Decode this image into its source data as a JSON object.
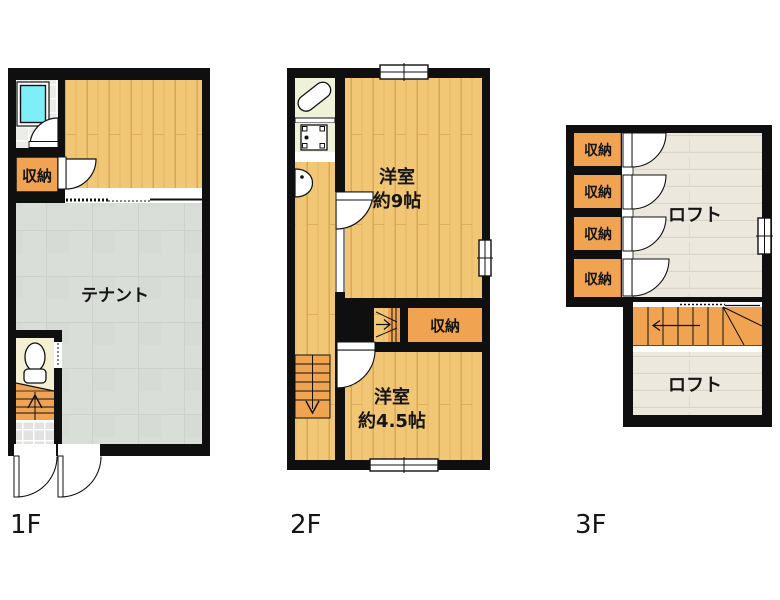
{
  "title": "3-story floor plan",
  "floors": [
    {
      "label": "1F",
      "rooms": [
        {
          "name": "storage",
          "label": "収納"
        },
        {
          "name": "tenant",
          "label": "テナント"
        }
      ],
      "fixtures": [
        "bathtub",
        "toilet",
        "stairs-up",
        "entry-doors"
      ]
    },
    {
      "label": "2F",
      "rooms": [
        {
          "name": "western-room-9",
          "label": "洋室",
          "size": "約9帖"
        },
        {
          "name": "storage",
          "label": "収納"
        },
        {
          "name": "western-room-4-5",
          "label": "洋室",
          "size": "約4.5帖"
        }
      ],
      "fixtures": [
        "bathtub",
        "washing-machine",
        "sink",
        "stairs-down",
        "stairs-up",
        "windows"
      ]
    },
    {
      "label": "3F",
      "rooms": [
        {
          "name": "storage-1",
          "label": "収納"
        },
        {
          "name": "storage-2",
          "label": "収納"
        },
        {
          "name": "storage-3",
          "label": "収納"
        },
        {
          "name": "storage-4",
          "label": "収納"
        },
        {
          "name": "loft-upper",
          "label": "ロフト"
        },
        {
          "name": "loft-lower",
          "label": "ロフト"
        }
      ],
      "fixtures": [
        "stairs-winder",
        "window"
      ]
    }
  ],
  "colors": {
    "wall": "#0f0f0f",
    "wood_floor": "#f1c674",
    "wood_plank_line": "#d9a854",
    "storage_orange": "#f0a351",
    "tenant_gray": "#dadenine",
    "tenant_floor": "#daded9",
    "loft_floor": "#ece8de",
    "cream_1f": "#f4f0d4",
    "cream_2f": "#eff2d8",
    "entry_tile": "#e2e2e0",
    "bath_tile": "#ececе8",
    "bath_tile_f": "#ecece8",
    "bathtub_cyan": "#7eeff6"
  },
  "icons": {
    "bathtub-icon": "rounded rectangle (tub seen from above)",
    "toilet-icon": "bowl ellipse + tank",
    "washing-machine-icon": "square with corner pads",
    "sink-icon": "half oval on wall",
    "door-arc": "quarter-circle swing",
    "window": "double-line in wall",
    "stairs": "treads with direction arrow"
  }
}
